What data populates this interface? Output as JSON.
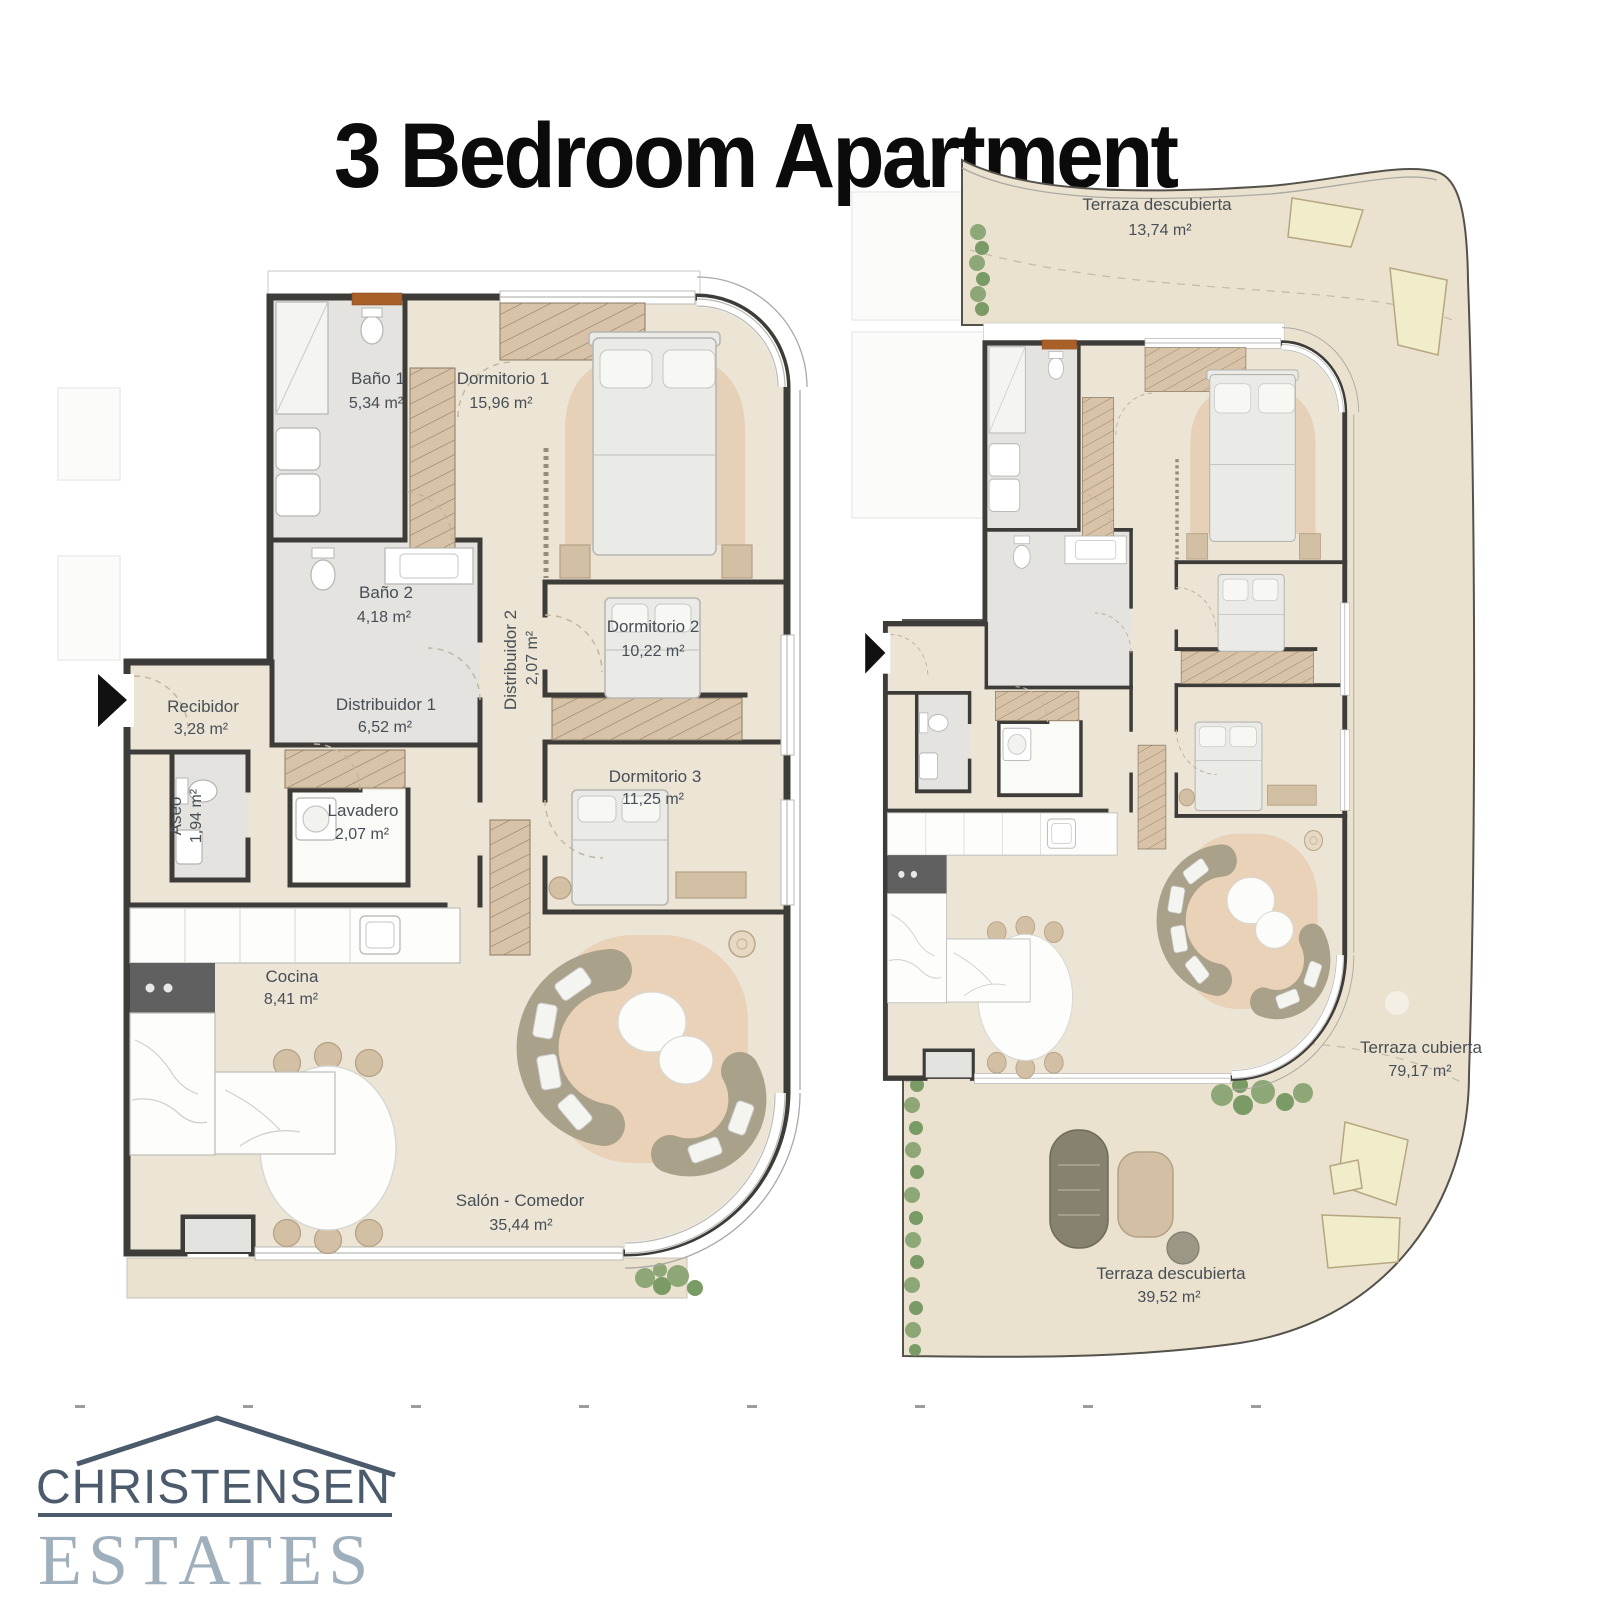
{
  "page": {
    "title": "3 Bedroom Apartment"
  },
  "plan_left": {
    "rooms": [
      {
        "label": "Baño 1",
        "area": "5,34 m²"
      },
      {
        "label": "Dormitorio 1",
        "area": "15,96 m²"
      },
      {
        "label": "Baño 2",
        "area": "4,18 m²"
      },
      {
        "label": "Distribuidor 2",
        "area": "2,07 m²"
      },
      {
        "label": "Dormitorio 2",
        "area": "10,22 m²"
      },
      {
        "label": "Recibidor",
        "area": "3,28 m²"
      },
      {
        "label": "Distribuidor 1",
        "area": "6,52 m²"
      },
      {
        "label": "Aseo",
        "area": "1,94 m²"
      },
      {
        "label": "Lavadero",
        "area": "2,07 m²"
      },
      {
        "label": "Dormitorio 3",
        "area": "11,25 m²"
      },
      {
        "label": "Cocina",
        "area": "8,41 m²"
      },
      {
        "label": "Salón - Comedor",
        "area": "35,44 m²"
      }
    ]
  },
  "plan_right": {
    "terraces": [
      {
        "label": "Terraza descubierta",
        "area": "13,74 m²"
      },
      {
        "label": "Terraza cubierta",
        "area": "79,17 m²"
      },
      {
        "label": "Terraza descubierta",
        "area": "39,52 m²"
      }
    ]
  },
  "logo": {
    "line1": "CHRISTENSEN",
    "line2": "ESTATES"
  },
  "colors": {
    "wall": "#3e3c39",
    "floor": "#ece5d6",
    "bath_floor": "#e4e3e0",
    "terrace": "#eae2cf",
    "wood": "#d8c2a8",
    "rug": "#e9d2b8",
    "sofa": "#a9a189",
    "label_text": "#474e55",
    "door_accent": "#a95f28",
    "logo_dark": "#4b5b6b",
    "logo_light": "#9fafbc"
  }
}
